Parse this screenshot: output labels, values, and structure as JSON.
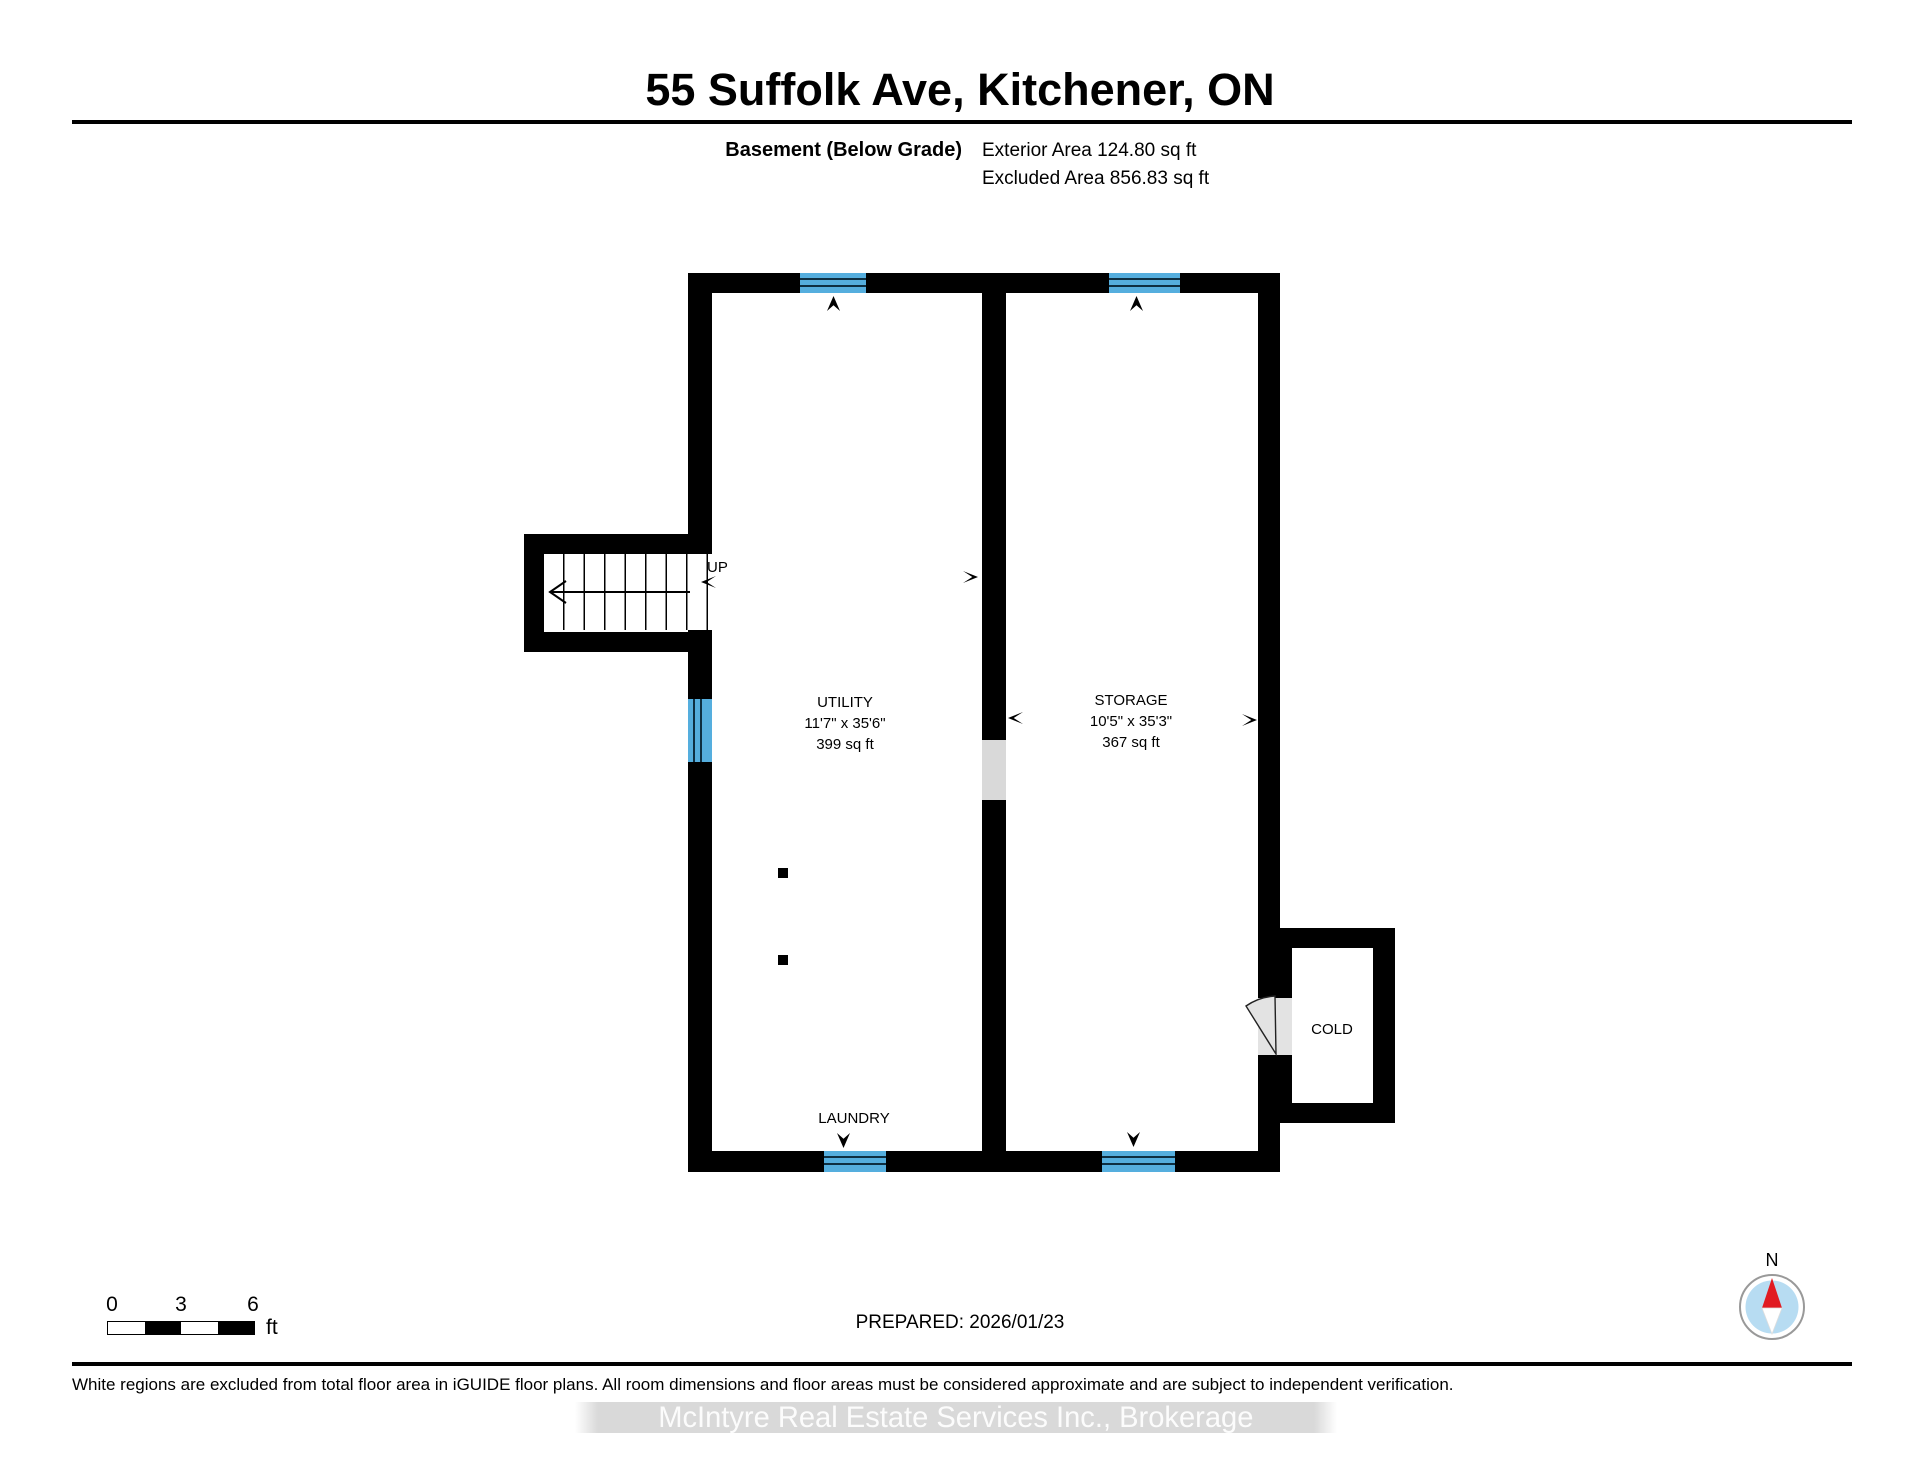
{
  "header": {
    "title": "55 Suffolk Ave, Kitchener, ON",
    "floor_label": "Basement (Below Grade)",
    "exterior_area": "Exterior Area 124.80 sq ft",
    "excluded_area": "Excluded Area 856.83 sq ft"
  },
  "plan": {
    "rooms": [
      {
        "id": "utility",
        "name": "UTILITY",
        "dims": "11'7\" x 35'6\"",
        "area": "399 sq ft"
      },
      {
        "id": "storage",
        "name": "STORAGE",
        "dims": "10'5\" x 35'3\"",
        "area": "367 sq ft"
      },
      {
        "id": "laundry",
        "name": "LAUNDRY"
      },
      {
        "id": "cold",
        "name": "COLD"
      }
    ],
    "stairs": {
      "label": "UP"
    }
  },
  "scale_bar": {
    "tick0": "0",
    "tick1": "3",
    "tick2": "6",
    "unit": "ft"
  },
  "compass": {
    "label": "N"
  },
  "footer": {
    "prepared": "PREPARED: 2026/01/23",
    "disclaimer": "White regions are excluded from total floor area in iGUIDE floor plans. All room dimensions and floor areas must be considered approximate and are subject to independent verification.",
    "watermark": "McIntyre Real Estate Services Inc., Brokerage"
  },
  "colors": {
    "wall": "#000000",
    "window_fill": "#55aede",
    "window_line": "#0e2f42",
    "opening_gray": "#d9d9d9",
    "door_gray": "#e3e3e3",
    "compass_blue": "#b7dcf2",
    "compass_red": "#e11b22",
    "compass_ring": "#999999",
    "watermark_bg": "#d9d9d9"
  }
}
